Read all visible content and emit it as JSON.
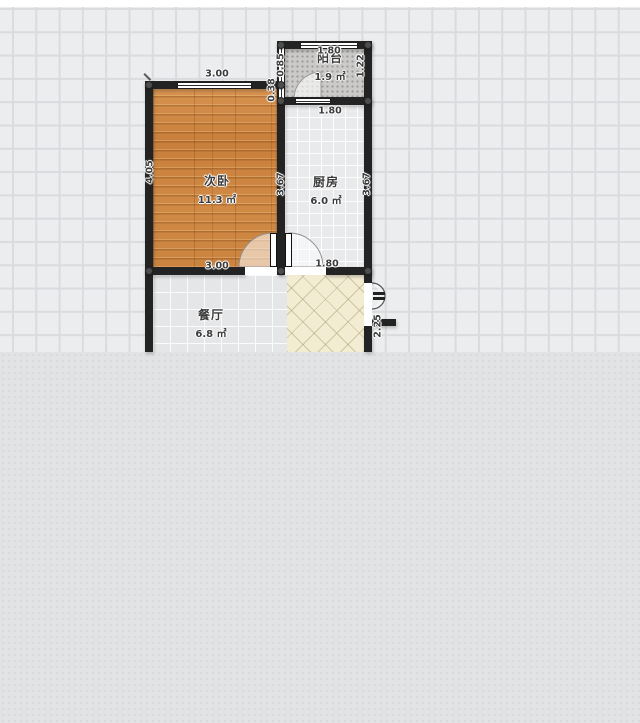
{
  "app": {
    "type": "floor-plan-editor-canvas",
    "colors": {
      "canvas_bg": "#ebedee",
      "grid_line": "#d9dbde",
      "bottom_panel": "#e2e3e5",
      "wall": "#232323",
      "wood_floor": "#cd8743",
      "tile_floor": "#e9eaec",
      "entry_floor": "#f2ecd2",
      "balcony_floor": "#cbcac8"
    }
  },
  "floorplan": {
    "rooms": [
      {
        "id": "balcony",
        "name": "阳台",
        "area": "1.9 ㎡"
      },
      {
        "id": "bedroom",
        "name": "次卧",
        "area": "11.3 ㎡"
      },
      {
        "id": "kitchen",
        "name": "厨房",
        "area": "6.0 ㎡"
      },
      {
        "id": "dining",
        "name": "餐厅",
        "area": "6.8 ㎡"
      }
    ],
    "dimensions": {
      "bedroom_top": "3.00",
      "bedroom_bottom": "3.00",
      "bedroom_left": "4.05",
      "bedroom_right": "3.67",
      "kitchen_right": "3.67",
      "kitchen_top": "1.80",
      "kitchen_bottom": "1.80",
      "balcony_top": "1.80",
      "balcony_left": "0.85",
      "balcony_right": "1.22",
      "wall_segment": "0.38",
      "entry_side": "2.25"
    }
  }
}
